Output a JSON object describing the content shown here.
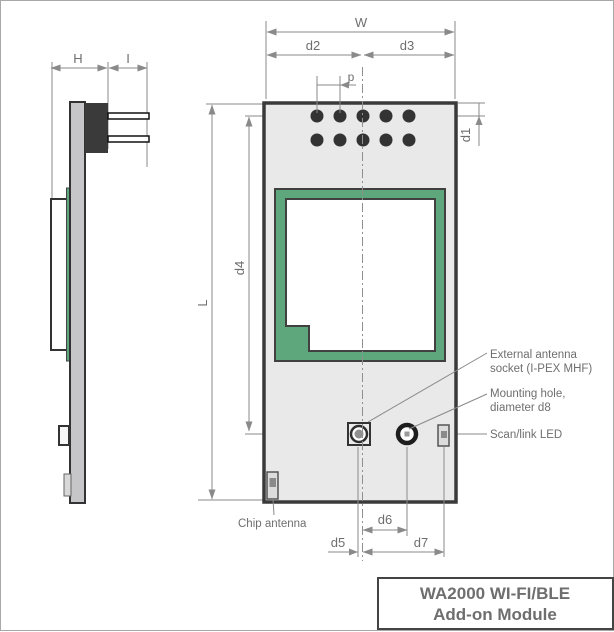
{
  "title_block": {
    "line1": "WA2000 WI-FI/BLE",
    "line2": "Add-on Module"
  },
  "dimension_labels": {
    "W": "W",
    "H": "H",
    "I": "I",
    "L": "L",
    "p": "p",
    "d1": "d1",
    "d2": "d2",
    "d3": "d3",
    "d4": "d4",
    "d5": "d5",
    "d6": "d6",
    "d7": "d7"
  },
  "callouts": {
    "external_antenna_line1": "External antenna",
    "external_antenna_line2": "socket (I-PEX MHF)",
    "mounting_hole_line1": "Mounting hole,",
    "mounting_hole_line2": "diameter d8",
    "scan_link_led": "Scan/link LED",
    "chip_antenna": "Chip antenna"
  },
  "colors": {
    "board_fill": "#e9e9ea",
    "pcb_green": "#5ea67c",
    "outline_dark": "#3a3a3a",
    "dimension_gray": "#8a8a8a",
    "text_gray": "#6e6e6e",
    "side_pcb_fill": "#c6c6c8",
    "connector_fill": "#3a3a3a",
    "title_text": "#111111"
  }
}
